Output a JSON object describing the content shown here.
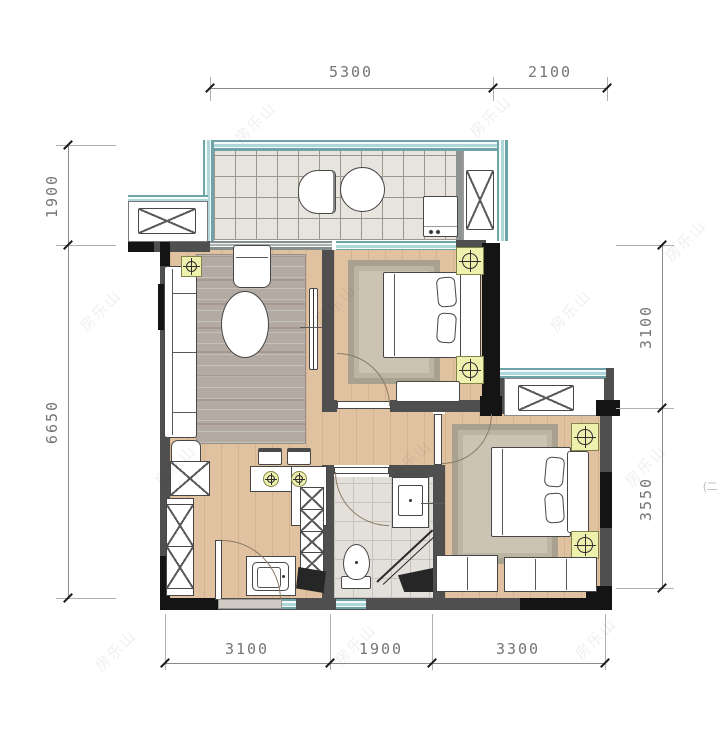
{
  "dimensions": {
    "top": [
      {
        "label": "5300"
      },
      {
        "label": "2100"
      }
    ],
    "left": [
      {
        "label": "1900"
      },
      {
        "label": "6650"
      }
    ],
    "right": [
      {
        "label": "3100"
      },
      {
        "label": "3550"
      }
    ],
    "bottom": [
      {
        "label": "3100"
      },
      {
        "label": "1900"
      },
      {
        "label": "3300"
      }
    ]
  },
  "watermark": {
    "text": "房乐山",
    "edge_text": "(二"
  },
  "colors": {
    "wall": "#4f4f4f",
    "wall_dark": "#141414",
    "window_teal": "#afd6d9",
    "window_border": "#6fa3a8",
    "wood_floor": "#e1c2a0",
    "balcony_tile": "#e7e4dd",
    "bath_tile": "#e3e0db",
    "rug": "#b3aba3",
    "lamp_symbol": "#eef0ae",
    "dimension_text": "#757575"
  }
}
